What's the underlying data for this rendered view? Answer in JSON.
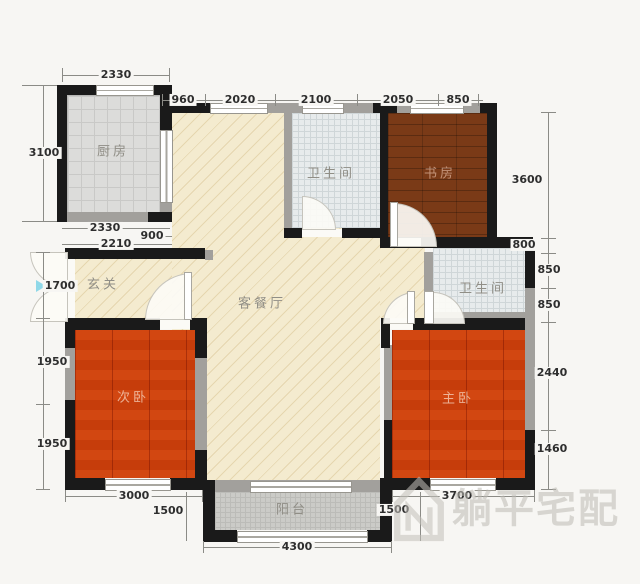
{
  "rooms": {
    "kitchen": "厨房",
    "bath_top": "卫生间",
    "study": "书房",
    "entry": "玄关",
    "living": "客餐厅",
    "bath_right": "卫生间",
    "bedroom_second": "次卧",
    "bedroom_master": "主卧",
    "balcony": "阳台"
  },
  "dims": {
    "top_outer": "2330",
    "top_row": [
      "960",
      "2020",
      "2100",
      "2050",
      "850"
    ],
    "left_col": [
      "3100",
      "1700",
      "1950",
      "1950"
    ],
    "kitchen_sub": [
      "2330",
      "900",
      "2210"
    ],
    "right_col": [
      "3600",
      "800",
      "850",
      "850",
      "2440",
      "1460"
    ],
    "bottom": [
      "3000",
      "1500",
      "4300",
      "1500",
      "3700"
    ]
  },
  "watermark": "躺平宅配",
  "colors": {
    "wall": "#1a1a1a",
    "wall_light": "#a2a09c",
    "wood_floor": "#e5823c",
    "study_floor": "#7a3a17",
    "living_floor": "#f4ebcf",
    "tile_floor": "#e7ebec",
    "balcony_floor": "#cbcbc7",
    "entry_arrow": "#8fd8e8",
    "dim_text": "#2e2e2e"
  }
}
